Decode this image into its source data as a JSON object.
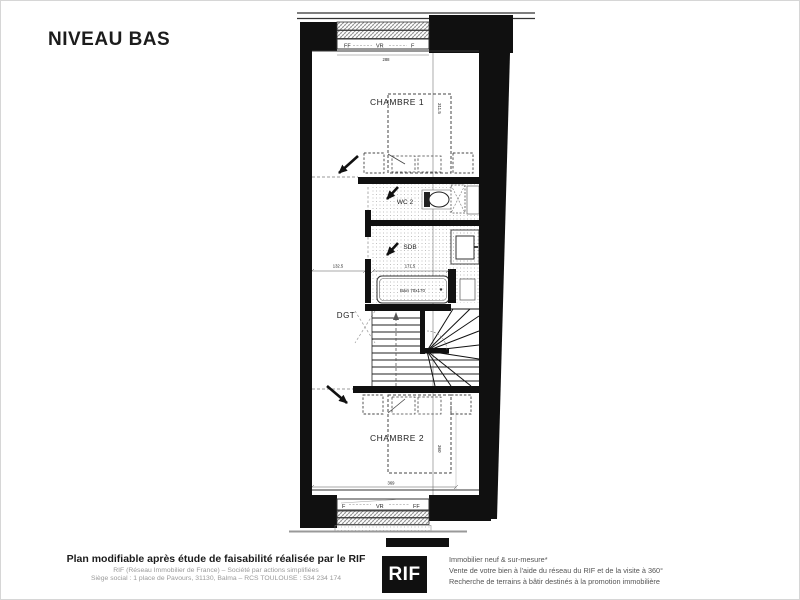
{
  "title": "NIVEAU BAS",
  "plan": {
    "rooms": {
      "chambre1": "CHAMBRE 1",
      "wc2": "WC 2",
      "sdb": "SDB",
      "dgt": "DGT",
      "chambre2": "CHAMBRE 2"
    },
    "fixtures": {
      "bath": "Bain 70x170"
    },
    "windows": {
      "top": {
        "left": "FF",
        "middle": "VR",
        "right": "F",
        "dim": "288"
      },
      "bottom": {
        "left": "F",
        "middle": "VR",
        "right": "FF"
      }
    },
    "dims": {
      "chambre1_depth": "311.5",
      "hall_width": "132.5",
      "bath_zone": "171.5",
      "chambre2_depth": "360",
      "chambre2_width": "369"
    }
  },
  "footer": {
    "left": {
      "line1": "Plan modifiable après étude de faisabilité réalisée par le RIF",
      "line2": "RIF (Réseau Immobilier de France) – Société par actions simplifiées",
      "line3": "Siège social : 1 place de Pavours, 31130, Balma – RCS TOULOUSE : 534 234 174"
    },
    "logo": "RIF",
    "right": {
      "line1": "Immobilier neuf & sur-mesure*",
      "line2": "Vente de votre bien à l'aide du réseau du RIF et de la visite à 360°",
      "line3": "Recherche de terrains à bâtir destinés à la promotion immobilière"
    }
  }
}
